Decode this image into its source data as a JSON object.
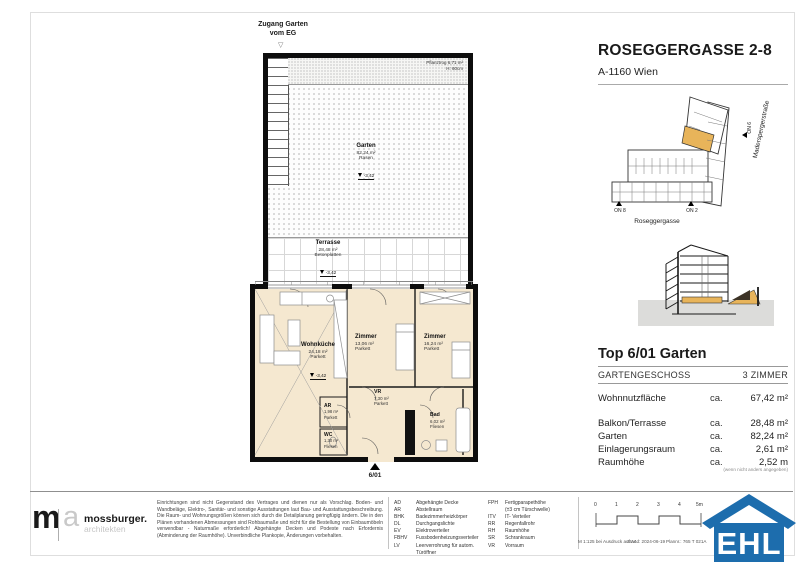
{
  "colors": {
    "unit_highlight": "#e8b45a",
    "ehl_blue": "#1d6dad",
    "room_fill": "#f5e8d0"
  },
  "header": {
    "title": "ROSEGGERGASSE 2-8",
    "subtitle": "A-1160 Wien"
  },
  "site_plan": {
    "street_side": "Maderspergerstraße",
    "street_bottom": "Roseggergasse",
    "marker_on8": "ON 8",
    "marker_on2": "ON 2",
    "marker_on6": "ON 6"
  },
  "plan": {
    "access_line1": "Zugang Garten",
    "access_line2": "vom EG",
    "planter_line1": "Pflanztrog 6,71 m²",
    "planter_line2": "H: 60cm",
    "garden": {
      "name": "Garten",
      "area": "82,24 m²",
      "surface": "Rasen",
      "level": "-3,42"
    },
    "terrace": {
      "name": "Terrasse",
      "area": "28,48 m²",
      "surface": "Betonplatten",
      "level": "-3,42"
    },
    "rooms": {
      "wohnkueche": {
        "name": "Wohnküche",
        "area": "24,18 m²",
        "surface": "Parkett",
        "level": "-3,42"
      },
      "zimmer1": {
        "name": "Zimmer",
        "area": "13,06 m²",
        "surface": "Parkett"
      },
      "zimmer2": {
        "name": "Zimmer",
        "area": "16,24 m²",
        "surface": "Parkett"
      },
      "vr": {
        "name": "VR",
        "area": "7,30 m²",
        "surface": "Parkett"
      },
      "ar": {
        "name": "AR",
        "area": "1,98 m²",
        "surface": "Parkett"
      },
      "wc": {
        "name": "WC",
        "area": "1,30 m²",
        "surface": "Fliesen"
      },
      "bad": {
        "name": "Bad",
        "area": "6,02 m²",
        "surface": "Fliesen"
      }
    },
    "entry_marker": "6/01"
  },
  "unit": {
    "title": "Top 6/01 Garten",
    "floor": "GARTENGESCHOSS",
    "room_count": "3 ZIMMER",
    "rows": [
      {
        "label": "Wohnnutzfläche",
        "ca": "ca.",
        "value": "67,42 m²"
      },
      {
        "label": "Balkon/Terrasse",
        "ca": "ca.",
        "value": "28,48 m²"
      },
      {
        "label": "Garten",
        "ca": "ca.",
        "value": "82,24 m²"
      },
      {
        "label": "Einlagerungsraum",
        "ca": "ca.",
        "value": "2,61 m²"
      },
      {
        "label": "Raumhöhe",
        "ca": "ca.",
        "value": "2,52 m"
      }
    ],
    "note": "(wenn nicht anders angegeben)"
  },
  "footer": {
    "architect": {
      "logo_m": "m",
      "logo_a": "a",
      "name": "mossburger.",
      "sub": "architekten"
    },
    "disclaimer": "Einrichtungen sind nicht Gegenstand des Vertrages und dienen nur als Vorschlag. Boden- und Wandbeläge, Elektro-, Sanitär- und sonstige Ausstattungen laut Bau- und Ausstattungsbeschreibung. Die Raum- und Wohnungsgrößen können sich durch die Detailplanung geringfügig ändern. Die in den Plänen vorhandenen Abmessungen sind Rohbaumaße und nicht für die Bestellung von Einbaumöbeln verwendbar - Naturmaße erforderlich! Abgehängte Decken und Podeste nach Erfordernis (Abminderung der Raumhöhe). Unverbindliche Plankopie, Änderungen vorbehalten.",
    "abbr_left": [
      {
        "k": "AD",
        "v": "Abgehängte Decke"
      },
      {
        "k": "AR",
        "v": "Abstellraum"
      },
      {
        "k": "BHK",
        "v": "Badezimmerheizkörper"
      },
      {
        "k": "DL",
        "v": "Durchgangslichte"
      },
      {
        "k": "EV",
        "v": "Elektroverteiler"
      },
      {
        "k": "FBHV",
        "v": "Fussbodenheizungsverteiler"
      },
      {
        "k": "LV",
        "v": "Leerverrohrung für autom. Türöffner"
      }
    ],
    "abbr_right": [
      {
        "k": "FPH",
        "v": "Fertigparapethöhe"
      },
      {
        "k": "",
        "v": "(±3 cm Türschwelle)"
      },
      {
        "k": "ITV",
        "v": "IT- Verteiler"
      },
      {
        "k": "RR",
        "v": "Regenfallrohr"
      },
      {
        "k": "RH",
        "v": "Raumhöhe"
      },
      {
        "k": "SR",
        "v": "Schrankraum"
      },
      {
        "k": "VR",
        "v": "Vorraum"
      }
    ],
    "scale_ticks": [
      "0",
      "1",
      "2",
      "3",
      "4",
      "5m"
    ],
    "print": {
      "scale_note": "M 1:125 bei Ausdruck auf A4",
      "stand": "Stand: 2024-06-19",
      "plannr": "Plannr.: 765 T 021A"
    },
    "ehl": "EHL"
  }
}
